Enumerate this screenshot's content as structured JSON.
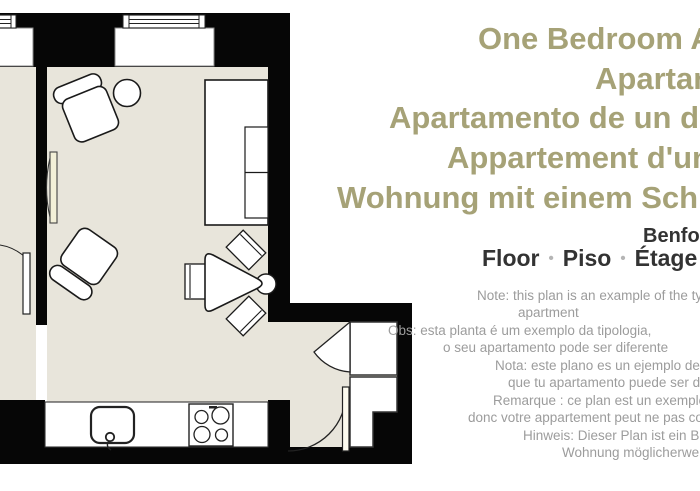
{
  "title": {
    "color": "#a6a277",
    "lines": [
      "One Bedroom Apartment",
      "Apartamento",
      "Apartamento de un dormitorio",
      "Appartement d'une chambre",
      "Wohnung mit einem Schlafzimmer"
    ]
  },
  "street": {
    "name": "Benformoso"
  },
  "floor_row": {
    "words": [
      "Floor",
      "Piso",
      "Étage"
    ],
    "separator": "•"
  },
  "notes": {
    "color": "#9c9c9c",
    "lines": [
      "Note: this plan is an example of the typology,",
      "apartment",
      "Obs: esta planta é um exemplo da tipologia,",
      "o seu apartamento pode ser diferente",
      "Nota: este plano es un ejemplo de la tipología,",
      "que tu apartamento puede ser diferente",
      "Remarque : ce plan est un exemple de la typologie,",
      "donc votre appartement peut ne pas correspondre",
      "Hinweis: Dieser Plan ist ein Beispiel,",
      "Wohnung möglicherweise anders"
    ]
  },
  "floorplan": {
    "floor_color": "#e8e5db",
    "wall_color": "#060606",
    "furniture_outline_color": "#1a1a1a",
    "door_leaf_color": "#f3f0d8",
    "elements": [
      "window",
      "window",
      "sofa",
      "round-table",
      "armchair",
      "armchair",
      "dining-table",
      "dining-chair",
      "dining-chair",
      "dining-chair",
      "kitchen-counter",
      "sink",
      "stove",
      "wardrobe",
      "wardrobe",
      "door",
      "door",
      "door",
      "door",
      "radiator"
    ]
  }
}
